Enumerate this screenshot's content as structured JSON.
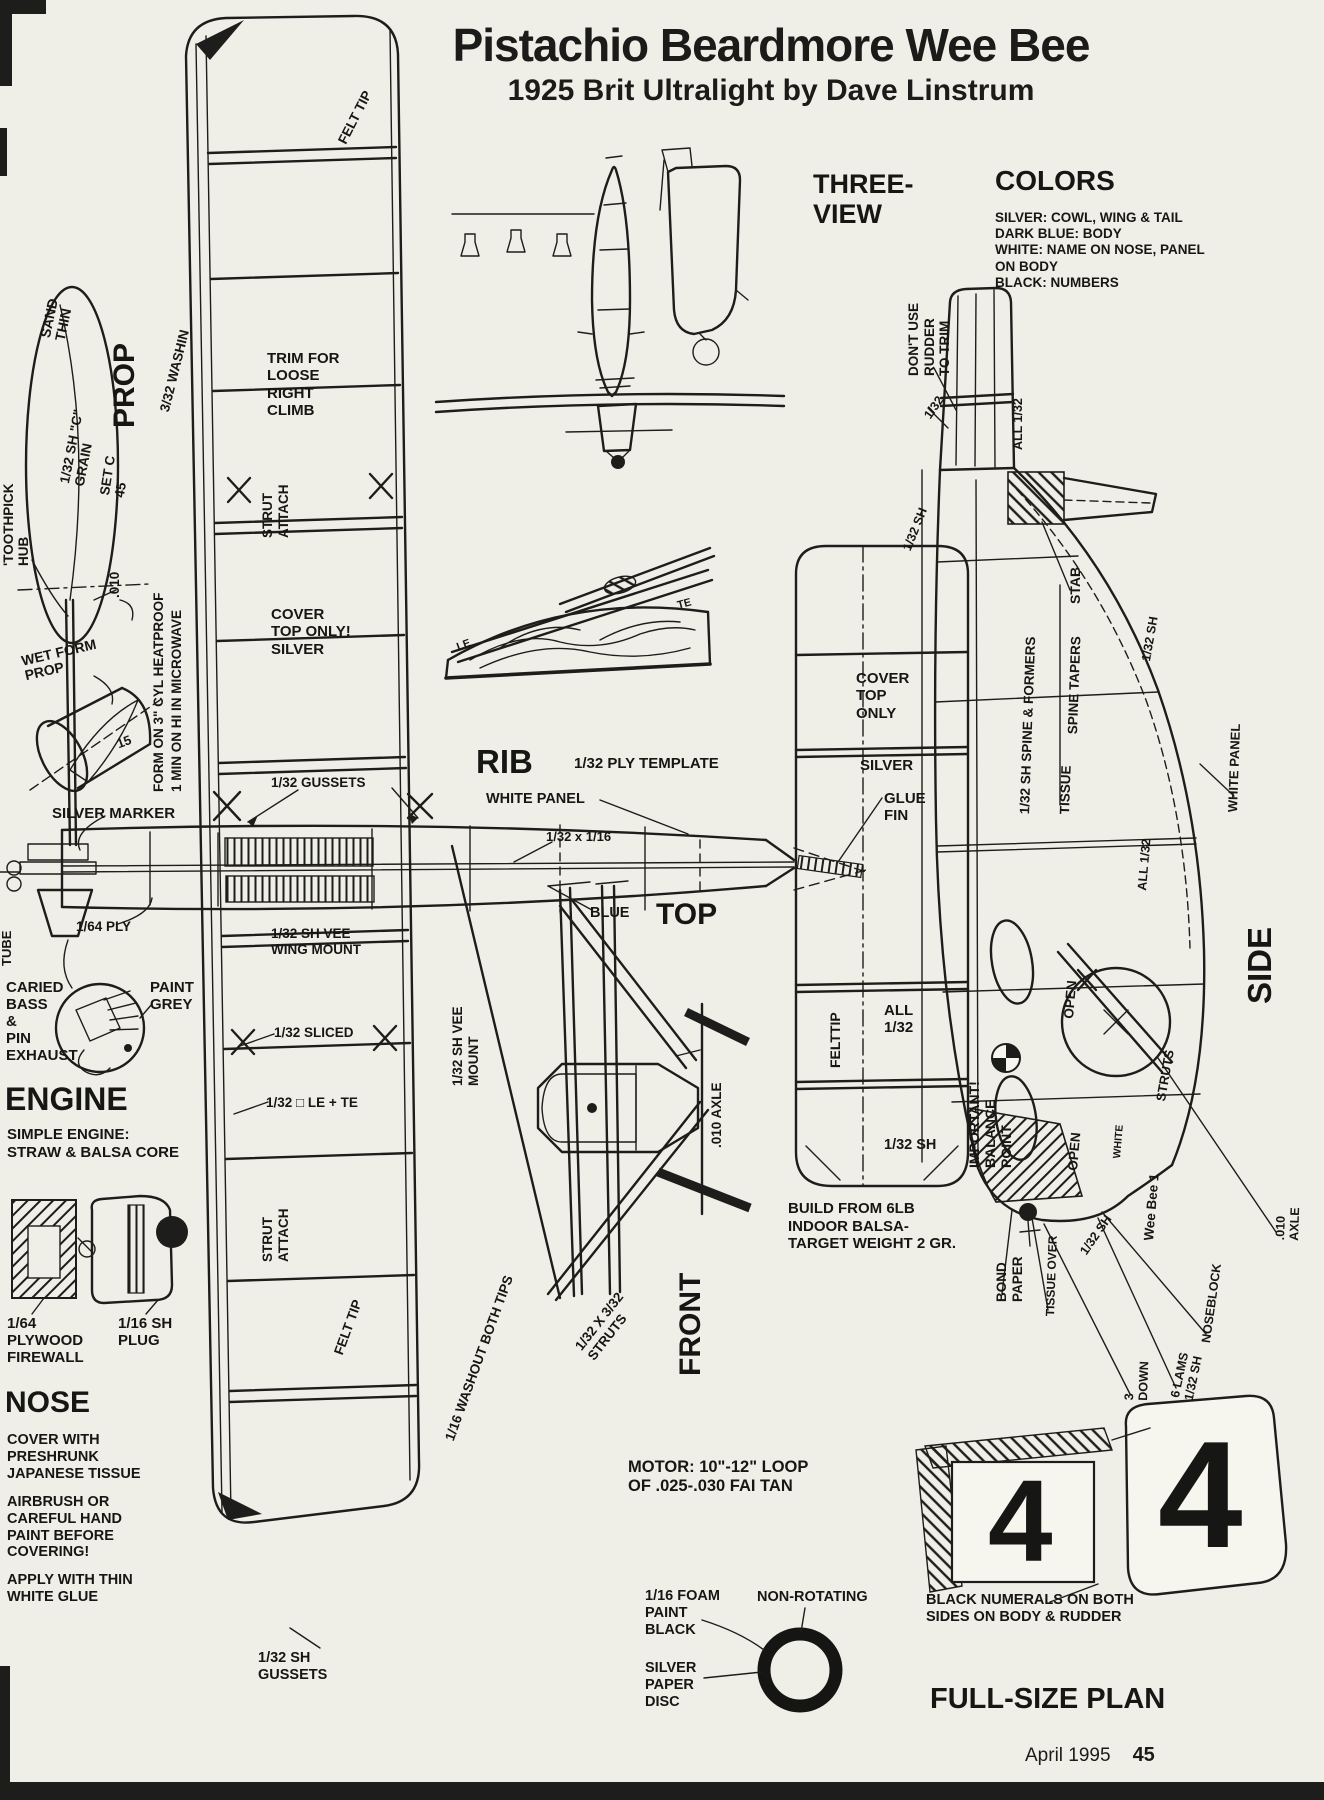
{
  "page": {
    "title": "Pistachio Beardmore Wee Bee",
    "subtitle": "1925 Brit Ultralight by Dave Linstrum",
    "footer_issue": "April 1995",
    "footer_page": "45",
    "paper_color": "#f0efe7",
    "ink_color": "#1d1d1b"
  },
  "labels": [
    {
      "name": "three-view-title",
      "text": "THREE-\nVIEW",
      "x": 813,
      "y": 170,
      "size": 27
    },
    {
      "name": "colors-title",
      "text": "COLORS",
      "x": 995,
      "y": 166,
      "size": 28
    },
    {
      "name": "colors-legend",
      "text": "SILVER: COWL, WING & TAIL\nDARK BLUE: BODY\nWHITE: NAME ON NOSE, PANEL\nON BODY\nBLACK: NUMBERS",
      "x": 995,
      "y": 210,
      "size": 13.5,
      "lh": 1.2
    },
    {
      "name": "prop-title",
      "text": "PROP",
      "x": 108,
      "y": 428,
      "size": 30,
      "rot": -90
    },
    {
      "name": "sand-thin-note",
      "text": "SAND\nTHIN",
      "x": 38,
      "y": 336,
      "size": 14,
      "rot": -78
    },
    {
      "name": "c-grain-note",
      "text": "1/32 SH \"C\"\nGRAIN",
      "x": 58,
      "y": 482,
      "size": 13.5,
      "rot": -79
    },
    {
      "name": "set-c-note",
      "text": "SET C\n45",
      "x": 98,
      "y": 494,
      "size": 13.5,
      "rot": -81
    },
    {
      "name": "toothpick-hub-note",
      "text": "'TOOTHPICK\nHUB",
      "x": 2,
      "y": 566,
      "size": 13.5,
      "rot": -90
    },
    {
      "name": "prop-wire-note",
      "text": ".010",
      "x": 108,
      "y": 598,
      "size": 13.5,
      "rot": -90
    },
    {
      "name": "wet-form-note",
      "text": "WET FORM\nPROP",
      "x": 20,
      "y": 654,
      "size": 14,
      "rot": -13
    },
    {
      "name": "cyl-15-note",
      "text": "15",
      "x": 115,
      "y": 738,
      "size": 13,
      "rot": -20
    },
    {
      "name": "microwave-note",
      "text": "FORM ON 3\" CYL HEATPROOF\n1 MIN ON HI IN MICROWAVE",
      "x": 150,
      "y": 792,
      "size": 13.5,
      "rot": -90,
      "lh": 1.3
    },
    {
      "name": "silver-marker-note",
      "text": "SILVER MARKER",
      "x": 52,
      "y": 806,
      "size": 15
    },
    {
      "name": "washin-note",
      "text": "3/32 WASHIN",
      "x": 158,
      "y": 410,
      "size": 13.5,
      "rot": -76
    },
    {
      "name": "felt-tip-top-note",
      "text": "FELT TIP",
      "x": 336,
      "y": 140,
      "size": 13.5,
      "rot": -63
    },
    {
      "name": "trim-note",
      "text": "TRIM FOR\nLOOSE\nRIGHT\nCLIMB",
      "x": 267,
      "y": 350,
      "size": 15,
      "lh": 1.16
    },
    {
      "name": "strut-attach-upper-note",
      "text": "STRUT\nATTACH",
      "x": 260,
      "y": 538,
      "size": 13.5,
      "rot": -90,
      "lh": 1.15
    },
    {
      "name": "cover-top-silver-note",
      "text": "COVER\nTOP ONLY!\nSILVER",
      "x": 271,
      "y": 606,
      "size": 15,
      "lh": 1.16
    },
    {
      "name": "gussets-132-note",
      "text": "1/32 GUSSETS",
      "x": 271,
      "y": 776,
      "size": 13.5
    },
    {
      "name": "rib-title",
      "text": "RIB",
      "x": 476,
      "y": 744,
      "size": 33
    },
    {
      "name": "ply-template-note",
      "text": "1/32 PLY TEMPLATE",
      "x": 574,
      "y": 756,
      "size": 15
    },
    {
      "name": "white-panel-top-note",
      "text": "WHITE PANEL",
      "x": 486,
      "y": 792,
      "size": 14.5
    },
    {
      "name": "strip-note",
      "text": "1/32 x 1/16",
      "x": 546,
      "y": 830,
      "size": 13
    },
    {
      "name": "blue-note",
      "text": "BLUE",
      "x": 590,
      "y": 906,
      "size": 14.5
    },
    {
      "name": "top-title",
      "text": "TOP",
      "x": 656,
      "y": 898,
      "size": 30
    },
    {
      "name": "vee-wing-mount-note",
      "text": "1/32 SH VEE\nWING MOUNT",
      "x": 271,
      "y": 926,
      "size": 13.5,
      "lh": 1.16
    },
    {
      "name": "sliced-note",
      "text": "1/32 SLICED",
      "x": 274,
      "y": 1026,
      "size": 13.5
    },
    {
      "name": "le-te-note",
      "text": "1/32 □ LE + TE",
      "x": 266,
      "y": 1096,
      "size": 13.5
    },
    {
      "name": "ply-164-note",
      "text": "1/64 PLY",
      "x": 76,
      "y": 920,
      "size": 13.5
    },
    {
      "name": "exhaust-note",
      "text": "CARIED\nBASS\n&\nPIN\nEXHAUST",
      "x": 6,
      "y": 980,
      "size": 15,
      "lh": 1.13
    },
    {
      "name": "paint-grey-note",
      "text": "PAINT\nGREY",
      "x": 150,
      "y": 980,
      "size": 15,
      "lh": 1.13
    },
    {
      "name": "engine-title",
      "text": "ENGINE",
      "x": 5,
      "y": 1082,
      "size": 32
    },
    {
      "name": "engine-sub",
      "text": "SIMPLE ENGINE:\nSTRAW & BALSA CORE",
      "x": 7,
      "y": 1126,
      "size": 15,
      "lh": 1.18
    },
    {
      "name": "tube-note",
      "text": "TUBE",
      "x": 0,
      "y": 966,
      "size": 13,
      "rot": -90
    },
    {
      "name": "firewall-note",
      "text": "1/64\nPLYWOOD\nFIREWALL",
      "x": 7,
      "y": 1316,
      "size": 15,
      "lh": 1.13
    },
    {
      "name": "plug-note",
      "text": "1/16 SH\nPLUG",
      "x": 118,
      "y": 1316,
      "size": 15,
      "lh": 1.13
    },
    {
      "name": "nose-title",
      "text": "NOSE",
      "x": 5,
      "y": 1386,
      "size": 30
    },
    {
      "name": "nose-cover-note",
      "text": "COVER WITH\nPRESHRUNK\nJAPANESE TISSUE",
      "x": 7,
      "y": 1432,
      "size": 14.5,
      "lh": 1.16
    },
    {
      "name": "airbrush-note",
      "text": "AIRBRUSH OR\nCAREFUL HAND\nPAINT BEFORE\nCOVERING!",
      "x": 7,
      "y": 1494,
      "size": 14.5,
      "lh": 1.16
    },
    {
      "name": "white-glue-note",
      "text": "APPLY WITH THIN\nWHITE GLUE",
      "x": 7,
      "y": 1572,
      "size": 14.5,
      "lh": 1.16
    },
    {
      "name": "strut-attach-lower-note",
      "text": "STRUT\nATTACH",
      "x": 260,
      "y": 1262,
      "size": 13.5,
      "rot": -90,
      "lh": 1.15
    },
    {
      "name": "felt-tip-bottom-note",
      "text": "FELT TIP",
      "x": 332,
      "y": 1352,
      "size": 13.5,
      "rot": -70
    },
    {
      "name": "washout-note",
      "text": "1/16 WASHOUT BOTH TIPS",
      "x": 443,
      "y": 1438,
      "size": 13.5,
      "rot": -70
    },
    {
      "name": "gussets-sh-note",
      "text": "1/32 SH\nGUSSETS",
      "x": 258,
      "y": 1650,
      "size": 14.5,
      "lh": 1.16
    },
    {
      "name": "vee-mount-note",
      "text": "1/32 SH VEE\nMOUNT",
      "x": 450,
      "y": 1086,
      "size": 13.5,
      "rot": -90,
      "lh": 1.15
    },
    {
      "name": "axle-010-front-note",
      "text": ".010 AXLE",
      "x": 710,
      "y": 1148,
      "size": 13.5,
      "rot": -90
    },
    {
      "name": "front-title",
      "text": "FRONT",
      "x": 674,
      "y": 1376,
      "size": 30,
      "rot": -90
    },
    {
      "name": "struts-note",
      "text": "1/32 X 3/32\nSTRUTS",
      "x": 572,
      "y": 1344,
      "size": 13.5,
      "rot": -52,
      "lh": 1.15
    },
    {
      "name": "motor-note",
      "text": "MOTOR: 10\"-12\" LOOP\nOF .025-.030 FAI TAN",
      "x": 628,
      "y": 1458,
      "size": 16.5,
      "lh": 1.18
    },
    {
      "name": "foam-note",
      "text": "1/16 FOAM\nPAINT\nBLACK",
      "x": 645,
      "y": 1588,
      "size": 14.5,
      "lh": 1.16
    },
    {
      "name": "non-rotating-note",
      "text": "NON-ROTATING",
      "x": 757,
      "y": 1590,
      "size": 14.5
    },
    {
      "name": "silver-disc-note",
      "text": "SILVER\nPAPER\nDISC",
      "x": 645,
      "y": 1660,
      "size": 14.5,
      "lh": 1.16
    },
    {
      "name": "cover-top-only-note",
      "text": "COVER\nTOP\nONLY",
      "x": 856,
      "y": 670,
      "size": 15,
      "lh": 1.16
    },
    {
      "name": "silver-fin-note",
      "text": "SILVER",
      "x": 860,
      "y": 758,
      "size": 15
    },
    {
      "name": "glue-fin-note",
      "text": "GLUE\nFIN",
      "x": 884,
      "y": 790,
      "size": 15,
      "lh": 1.16
    },
    {
      "name": "felttip-fin-note",
      "text": "FELTTIP",
      "x": 828,
      "y": 1068,
      "size": 14,
      "rot": -90
    },
    {
      "name": "all-132-fin-note",
      "text": "ALL\n1/32",
      "x": 884,
      "y": 1002,
      "size": 15,
      "lh": 1.16
    },
    {
      "name": "sh-132-fin-note",
      "text": "1/32 SH",
      "x": 884,
      "y": 1138,
      "size": 14.5
    },
    {
      "name": "build-note",
      "text": "BUILD FROM 6LB\nINDOOR BALSA-\nTARGET WEIGHT 2 GR.",
      "x": 788,
      "y": 1200,
      "size": 15,
      "lh": 1.18
    },
    {
      "name": "balance-note",
      "text": "IMPORTANT!\nBALANCE\nPOINT",
      "x": 966,
      "y": 1168,
      "size": 14,
      "rot": -90,
      "lh": 1.15
    },
    {
      "name": "rudder-trim-note",
      "text": "DON'T USE\nRUDDER\nTO TRIM",
      "x": 906,
      "y": 376,
      "size": 13.5,
      "rot": -90,
      "lh": 1.15
    },
    {
      "name": "fin-132-note",
      "text": "1/32",
      "x": 922,
      "y": 414,
      "size": 12.5,
      "rot": -55
    },
    {
      "name": "fin-all-132-note",
      "text": "ALL 1/32",
      "x": 1012,
      "y": 450,
      "size": 12.5,
      "rot": -90
    },
    {
      "name": "side-sh-132-a-note",
      "text": "1/32 SH",
      "x": 901,
      "y": 548,
      "size": 12.5,
      "rot": -68
    },
    {
      "name": "stab-note",
      "text": "STAB",
      "x": 1068,
      "y": 604,
      "size": 14,
      "rot": -90
    },
    {
      "name": "spine-tapers-note",
      "text": "SPINE TAPERS",
      "x": 1066,
      "y": 734,
      "size": 13.5,
      "rot": -88
    },
    {
      "name": "spine-formers-note",
      "text": "1/32 SH SPINE & FORMERS",
      "x": 1018,
      "y": 814,
      "size": 13.5,
      "rot": -88
    },
    {
      "name": "tissue-note",
      "text": "TISSUE",
      "x": 1058,
      "y": 814,
      "size": 13.5,
      "rot": -88
    },
    {
      "name": "stab-sh-132-note",
      "text": "1/32 SH",
      "x": 1140,
      "y": 660,
      "size": 12.5,
      "rot": -80
    },
    {
      "name": "white-panel-side-note",
      "text": "WHITE PANEL",
      "x": 1226,
      "y": 812,
      "size": 13,
      "rot": -88
    },
    {
      "name": "side-all-132-note",
      "text": "ALL 1/32",
      "x": 1136,
      "y": 890,
      "size": 12.5,
      "rot": -85
    },
    {
      "name": "side-title",
      "text": "SIDE",
      "x": 1242,
      "y": 1004,
      "size": 33,
      "rot": -90
    },
    {
      "name": "open-upper-note",
      "text": "OPEN",
      "x": 1062,
      "y": 1018,
      "size": 13.5,
      "rot": -85
    },
    {
      "name": "open-lower-note",
      "text": "OPEN",
      "x": 1066,
      "y": 1170,
      "size": 13.5,
      "rot": -85
    },
    {
      "name": "struts-side-note",
      "text": "STRUTS",
      "x": 1154,
      "y": 1100,
      "size": 13,
      "rot": -80
    },
    {
      "name": "white-side-note",
      "text": "WHITE",
      "x": 1112,
      "y": 1158,
      "size": 10.5,
      "rot": -85
    },
    {
      "name": "wee-bee-name",
      "text": "Wee Bee 1",
      "x": 1142,
      "y": 1240,
      "size": 13.5,
      "rot": -85
    },
    {
      "name": "side-sh-132-b-note",
      "text": "1/32 SH",
      "x": 1078,
      "y": 1250,
      "size": 12.5,
      "rot": -55
    },
    {
      "name": "bond-paper-note",
      "text": "BOND\nPAPER",
      "x": 994,
      "y": 1302,
      "size": 13.5,
      "rot": -90,
      "lh": 1.15
    },
    {
      "name": "tissue-over-note",
      "text": "TISSUE OVER",
      "x": 1044,
      "y": 1316,
      "size": 12,
      "rot": -88
    },
    {
      "name": "noseblock-note",
      "text": "NOSEBLOCK",
      "x": 1200,
      "y": 1342,
      "size": 12.5,
      "rot": -82
    },
    {
      "name": "lams-note",
      "text": "6 LAMS\n1/32 SH",
      "x": 1168,
      "y": 1396,
      "size": 12.5,
      "rot": -78,
      "lh": 1.15
    },
    {
      "name": "down-3-note",
      "text": "3\nDOWN",
      "x": 1122,
      "y": 1400,
      "size": 12.5,
      "rot": -88,
      "lh": 1.15
    },
    {
      "name": "axle-010-side-note",
      "text": ".010 AXLE",
      "x": 1274,
      "y": 1240,
      "size": 12.5,
      "rot": -88
    },
    {
      "name": "numerals-caption",
      "text": "BLACK NUMERALS ON BOTH\nSIDES ON BODY & RUDDER",
      "x": 926,
      "y": 1592,
      "size": 14.5,
      "lh": 1.18
    },
    {
      "name": "full-size-plan-title",
      "text": "FULL-SIZE PLAN",
      "x": 930,
      "y": 1684,
      "size": 29
    },
    {
      "name": "rudder-numeral-4",
      "text": "4",
      "x": 988,
      "y": 1458,
      "size": 116
    },
    {
      "name": "body-numeral-4",
      "text": "4",
      "x": 1158,
      "y": 1412,
      "size": 152
    },
    {
      "name": "rib-le-mark",
      "text": "LE",
      "x": 455,
      "y": 642,
      "size": 11,
      "rot": -20
    },
    {
      "name": "rib-te-mark",
      "text": "TE",
      "x": 676,
      "y": 600,
      "size": 11,
      "rot": -15
    }
  ]
}
